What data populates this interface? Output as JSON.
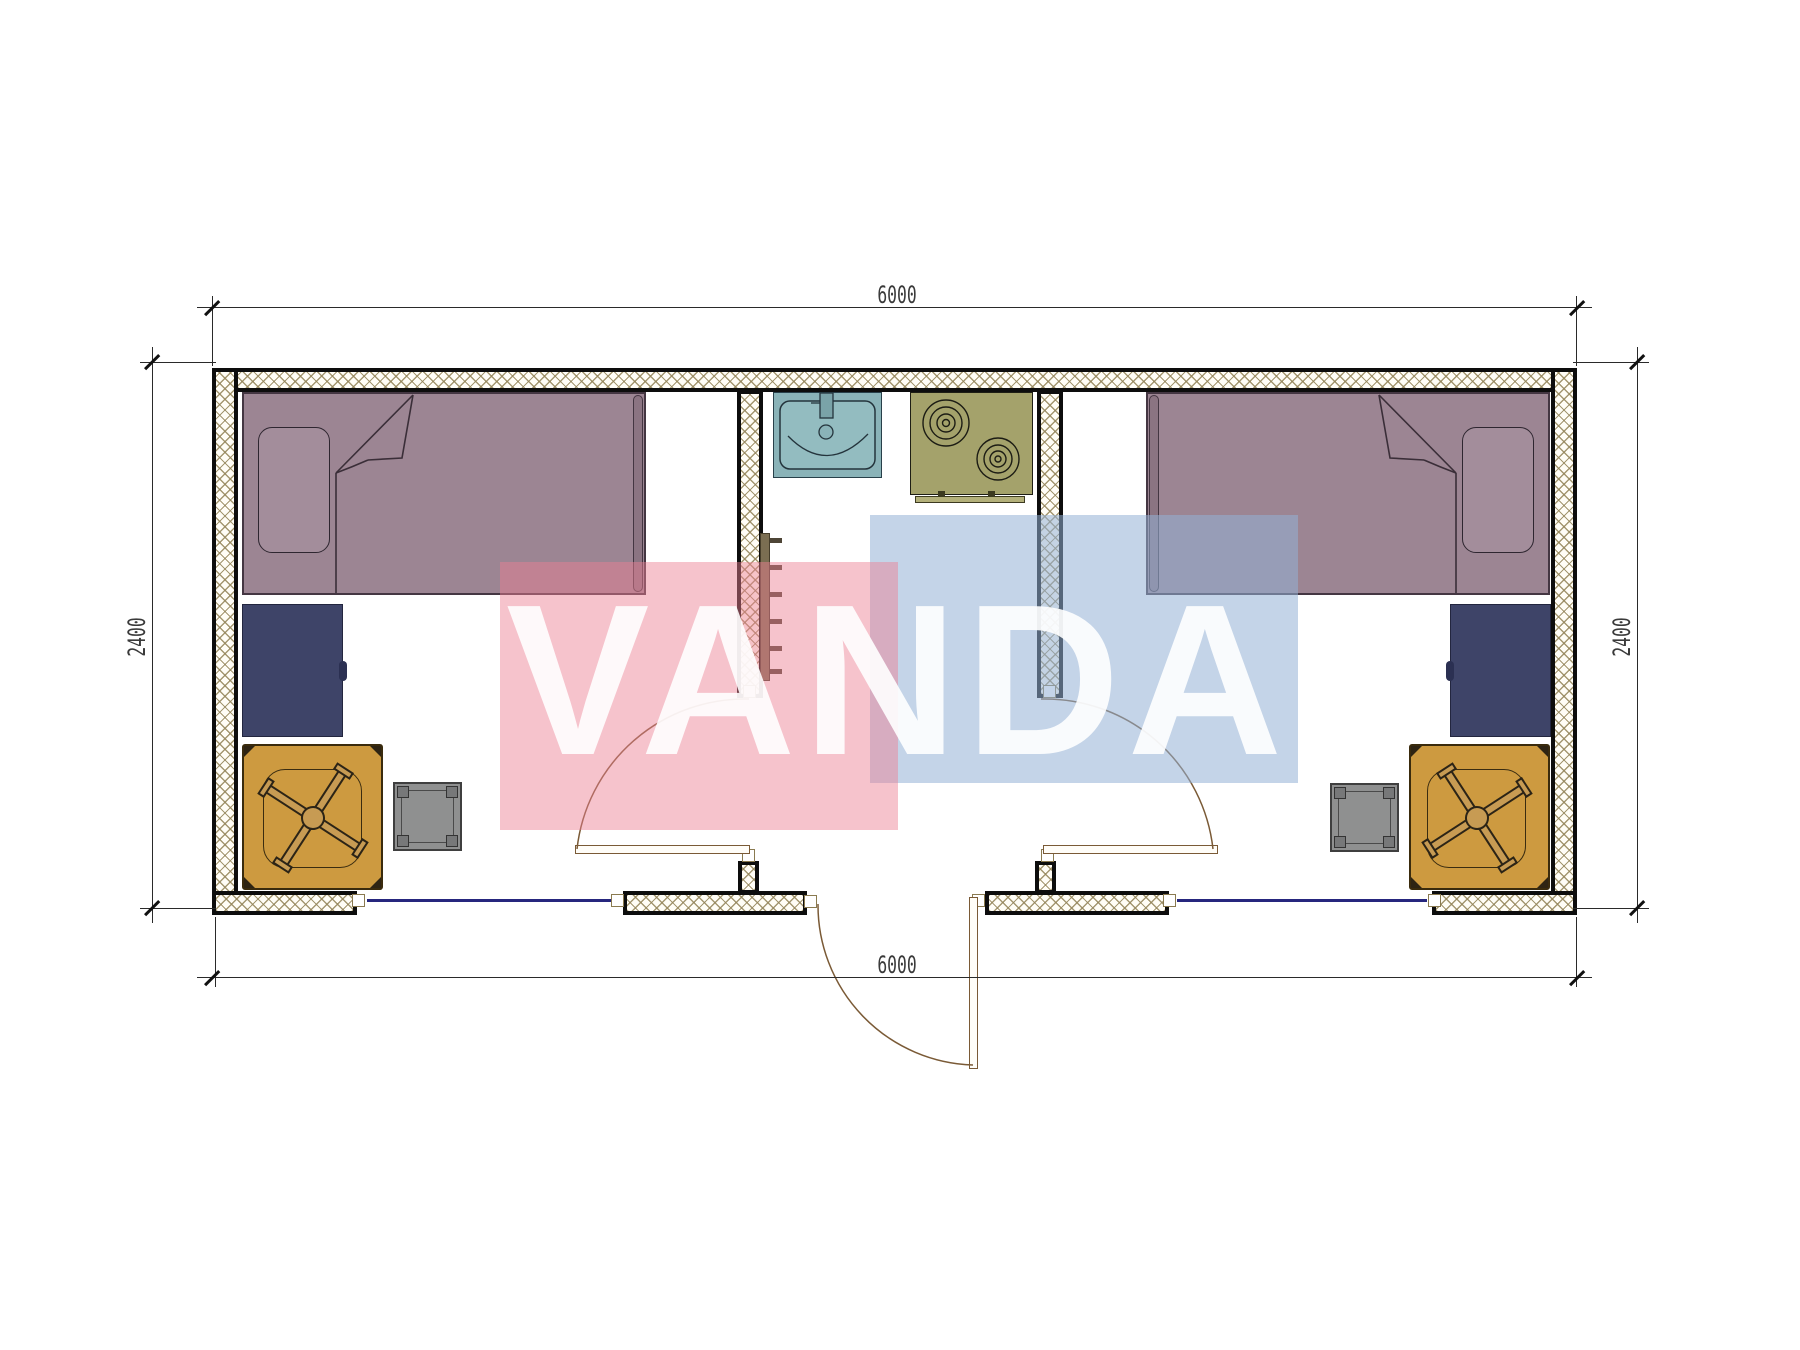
{
  "drawing": {
    "type": "floor-plan",
    "building": "two-room modular container unit with central entry / kitchenette",
    "background": "#ffffff"
  },
  "dimensions": {
    "top": "6000",
    "bottom": "6000",
    "left": "2400",
    "right": "2400"
  },
  "watermark": {
    "text": "VANDA",
    "pink_color": "#eb8092",
    "blue_color": "#93b1d5",
    "text_color": "#ffffff"
  },
  "palette": {
    "wall_hatch": "#94855a",
    "outline": "#0d0d0d",
    "bed": "#9c8593",
    "pillow": "#a38d9b",
    "wardrobe": "#3e4468",
    "desk": "#cd9a40",
    "chair": "#c79b53",
    "stool": "#8f9090",
    "sink": "#8ab3b8",
    "stove": "#a4a26b",
    "window_glazing": "#26267e",
    "door_swing": "#7a5a36",
    "coat_rack": "#7b6e52"
  },
  "inventory": {
    "left_room": [
      "single-bed",
      "wardrobe",
      "desk",
      "office-chair",
      "stool",
      "window",
      "interior-door"
    ],
    "entry_kitchen": [
      "wash-basin",
      "two-burner-cooktop",
      "coat-rack",
      "exterior-door"
    ],
    "right_room": [
      "single-bed",
      "wardrobe",
      "desk",
      "office-chair",
      "stool",
      "window",
      "interior-door"
    ]
  }
}
